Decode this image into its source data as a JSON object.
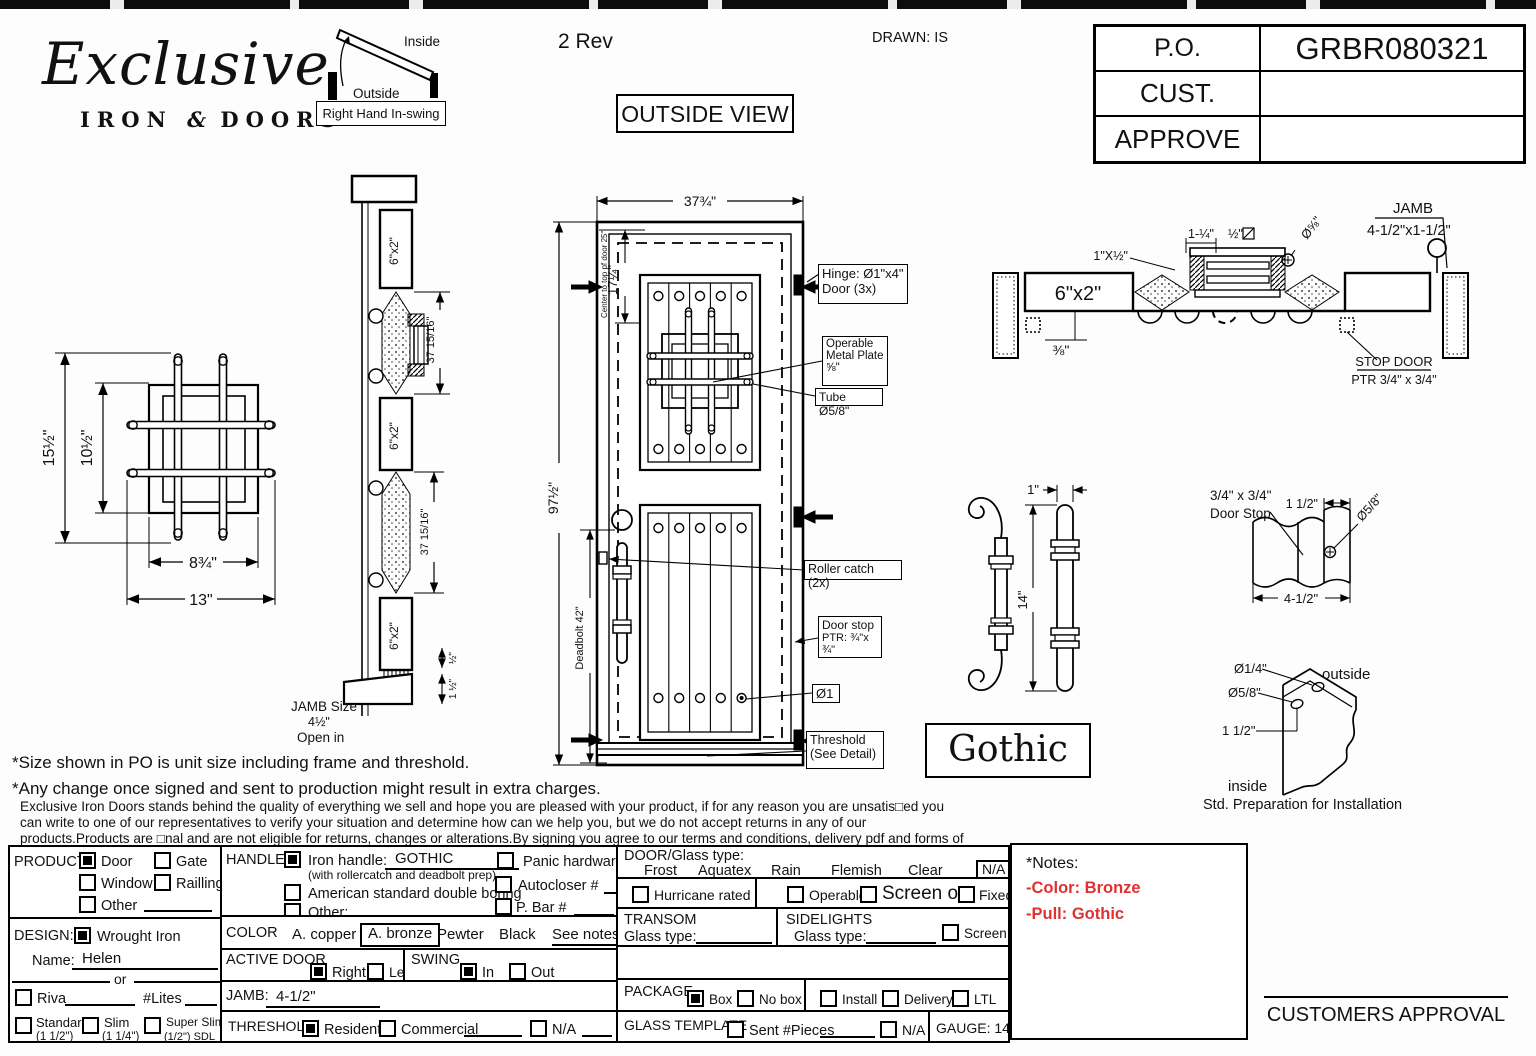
{
  "colors": {
    "note_red": "#e03131"
  },
  "header": {
    "logo_script": "Exclusive",
    "logo_iron": "IRON",
    "logo_amp": "&",
    "logo_doors": "DOORS",
    "rev": "2 Rev",
    "drawn": "DRAWN: IS",
    "view_label": "OUTSIDE VIEW",
    "swing_diagram": {
      "inside": "Inside",
      "outside": "Outside",
      "label": "Right Hand In-swing"
    },
    "po_table": {
      "rows": [
        {
          "label": "P.O.",
          "value": "GRBR080321"
        },
        {
          "label": "CUST.",
          "value": ""
        },
        {
          "label": "APPROVE",
          "value": ""
        }
      ]
    }
  },
  "grille_detail": {
    "dim_outer_h": "15½\"",
    "dim_inner_h": "10½\"",
    "dim_inner_w": "8¾\"",
    "dim_outer_w": "13\""
  },
  "vsection": {
    "tube": "6\"x2\"",
    "dim_upper": "37 15/16\"",
    "dim_lower": "37 15/16\"",
    "dim_half": "½\"",
    "dim_one_half": "1 ½\"",
    "jamb_size_1": "JAMB Size",
    "jamb_size_2": "4½\"",
    "jamb_size_3": "Open in"
  },
  "door": {
    "dim_width": "37¾\"",
    "dim_height": "97½\"",
    "dim_17": "17¼\"",
    "center_note": "Center to top pf door 25\"",
    "deadbolt": "Deadbolt 42\"",
    "hinge_1": "Hinge: Ø1\"x4\"",
    "hinge_2": "Door (3x)",
    "plate_1": "Operable",
    "plate_2": "Metal Plate",
    "plate_3": "⅝\"",
    "tube": "Tube Ø5/8\"",
    "roller": "Roller catch  (2x)",
    "stop_1": "Door stop",
    "stop_2": "PTR: ¾\"x ¾\"",
    "dia1": "Ø1",
    "threshold_1": "Threshold",
    "threshold_2": "(See Detail)"
  },
  "hsection": {
    "title": "JAMB",
    "size": "4-1/2\"x1-1/2\"",
    "tube": "6\"x2\"",
    "dim_38": "⅜\"",
    "dim_1x12": "1\"X½\"",
    "dim_114": "1-¼\"",
    "dim_12": "½\"",
    "dia_58": "Ø⅝\"",
    "stop_1": "STOP DOOR",
    "stop_2": "PTR 3/4\" x 3/4\""
  },
  "handle_detail": {
    "dim_1": "1\"",
    "dim_14": "14\"",
    "style": "Gothic"
  },
  "stop_detail": {
    "label_1": "3/4\" x 3/4\"",
    "label_2": "Door Stop",
    "dim_112": "1 1/2\"",
    "dia": "Ø5/8\"",
    "dim_412": "4-1/2\""
  },
  "prep_detail": {
    "dia_14": "Ø1/4\"",
    "dia_58": "Ø5/8\"",
    "dim_112": "1 1/2\"",
    "outside": "outside",
    "inside": "inside",
    "caption": "Std. Preparation for Installation"
  },
  "notes_top": {
    "line1": "*Size shown in PO is unit size including frame and threshold.",
    "line2": "*Any change once signed and sent to production might result in extra charges.",
    "para": "Exclusive Iron Doors stands behind the quality of everything we sell and hope you are pleased with your product, if for any reason you are unsatis□ed you can write to one of our representatives to verify your situation and determine how can we help you, but we do not accept returns in any of our products.Products are □nal and are not eligible for returns, changes or alterations.By signing you agree to our terms and conditions, delivery pdf and forms of payment. *Doors measurements do not include the gaps between jambs"
  },
  "form": {
    "product": {
      "label": "PRODUCT:",
      "door": "Door",
      "gate": "Gate",
      "window": "Window",
      "railing": "Railling",
      "other": "Other"
    },
    "design": {
      "label": "DESIGN:",
      "wrought": "Wrought Iron",
      "name_label": "Name:",
      "name_value": "Helen",
      "or": "or",
      "riva": "Riva",
      "lites": "#Lites",
      "standard": "Standard",
      "standard_sub": "(1 1/2\")",
      "slim": "Slim",
      "slim_sub": "(1 1/4\")",
      "super": "Super Slim",
      "super_sub": "(1/2\") SDL"
    },
    "handle": {
      "label": "HANDLE",
      "iron": "Iron handle:",
      "iron_value": "GOTHIC",
      "iron_sub": "(with rollercatch and deadbolt prep)",
      "american": "American standard double boring",
      "other": "Other:",
      "panic": "Panic hardware",
      "autocloser": "Autocloser #",
      "pbar": "P. Bar #"
    },
    "color": {
      "label": "COLOR",
      "copper": "A. copper",
      "bronze": "A. bronze",
      "pewter": "Pewter",
      "black": "Black",
      "see_notes": "See notes*"
    },
    "active": {
      "label": "ACTIVE DOOR",
      "right": "Right",
      "left": "Left"
    },
    "swing": {
      "label": "SWING",
      "in": "In",
      "out": "Out"
    },
    "jamb": {
      "label": "JAMB:",
      "value": "4-1/2\""
    },
    "threshold": {
      "label": "THRESHOLD",
      "residential": "Residential",
      "commercial": "Commercial",
      "na": "N/A"
    },
    "door_glass": {
      "label": "DOOR/Glass type:",
      "frost": "Frost",
      "aquatex": "Aquatex",
      "rain": "Rain",
      "flemish": "Flemish",
      "clear": "Clear",
      "na": "N/A"
    },
    "hurricane": "Hurricane rated",
    "operable": "Operable",
    "screen_or": "Screen or",
    "fixed": "Fixed",
    "transom": {
      "label": "TRANSOM",
      "glass": "Glass type:"
    },
    "sidelights": {
      "label": "SIDELIGHTS",
      "glass": "Glass type:",
      "screen": "Screen"
    },
    "package": {
      "label": "PACKAGE",
      "box": "Box",
      "nobox": "No box",
      "install": "Install",
      "delivery": "Delivery",
      "ltl": "LTL"
    },
    "template": {
      "label": "GLASS TEMPLATE",
      "sent": "Sent #Pieces",
      "na": "N/A"
    },
    "gauge": "GAUGE: 14"
  },
  "side_notes": {
    "title": "*Notes:",
    "line1": "-Color: Bronze",
    "line2": "-Pull: Gothic"
  },
  "approval": "CUSTOMERS APPROVAL"
}
